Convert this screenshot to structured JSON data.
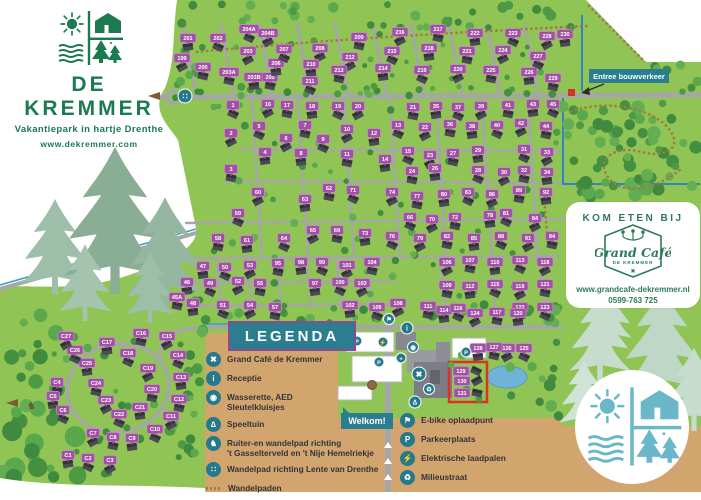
{
  "branding": {
    "name": "DE KREMMER",
    "tagline": "Vakantiepark in hartje Drenthe",
    "website": "www.dekremmer.com"
  },
  "cafe": {
    "heading": "KOM ETEN BIJ",
    "name": "Grand Café",
    "subname": "DE KREMMER",
    "website": "www.grandcafe-dekremmer.nl",
    "phone": "0599-763 725"
  },
  "signs": {
    "legend_title": "LEGENDA",
    "welcome": "Welkom!",
    "construction_entrance": "Entree bouwverkeer"
  },
  "legend": {
    "left": [
      {
        "icon": "utensils-icon",
        "glyph": "✖",
        "lines": [
          "Grand Café de Kremmer"
        ]
      },
      {
        "icon": "info-icon",
        "glyph": "i",
        "lines": [
          "Receptie"
        ]
      },
      {
        "icon": "washer-icon",
        "glyph": "◉",
        "lines": [
          "Wasserette, AED",
          "Sleutelkluisjes"
        ]
      },
      {
        "icon": "playground-icon",
        "glyph": "∆",
        "lines": [
          "Speeltuin"
        ]
      },
      {
        "icon": "horse-icon",
        "glyph": "♞",
        "lines": [
          "Ruiter-en wandelpad richting",
          "'t Gasselterveld en 't Nije Hemelriekje"
        ]
      },
      {
        "icon": "footsteps-icon",
        "glyph": "∷",
        "lines": [
          "Wandelpad richting Lente van Drenthe"
        ]
      },
      {
        "icon": "dashed-path-icon",
        "glyph": "",
        "lines": [
          "Wandelpaden"
        ]
      }
    ],
    "right": [
      {
        "icon": "ebike-icon",
        "glyph": "⚑",
        "lines": [
          "E-bike oplaadpunt"
        ]
      },
      {
        "icon": "parking-icon",
        "glyph": "P",
        "lines": [
          "Parkeerplaats"
        ]
      },
      {
        "icon": "ev-charger-icon",
        "glyph": "⚡",
        "lines": [
          "Elektrische laadpalen"
        ]
      },
      {
        "icon": "trash-icon",
        "glyph": "♻",
        "lines": [
          "Milieustraat"
        ]
      }
    ]
  },
  "colors": {
    "map_green": "#90c454",
    "sand": "#d2a56f",
    "road": "#a6a6a9",
    "teal": "#25798b",
    "banner_teal": "#2a7e90",
    "banner_border": "#8d4a8f",
    "label_purple": "#a151a3",
    "brand_green": "#1b7a4f",
    "cafe_green": "#2d7a57",
    "blue_route": "#2f86c4",
    "highlight_red": "#e03024"
  },
  "map": {
    "houses": [
      [
        "199",
        182,
        58
      ],
      [
        "200",
        203,
        67
      ],
      [
        "201",
        188,
        38
      ],
      [
        "202",
        218,
        38
      ],
      [
        "203",
        248,
        51
      ],
      [
        "203A",
        229,
        72
      ],
      [
        "203B",
        254,
        77
      ],
      [
        "204A",
        249,
        29
      ],
      [
        "204B",
        268,
        33
      ],
      [
        "205",
        270,
        77
      ],
      [
        "206",
        276,
        63
      ],
      [
        "207",
        284,
        49
      ],
      [
        "208",
        320,
        48
      ],
      [
        "209",
        359,
        37
      ],
      [
        "210",
        311,
        64
      ],
      [
        "211",
        310,
        81
      ],
      [
        "212",
        350,
        57
      ],
      [
        "213",
        339,
        70
      ],
      [
        "214",
        383,
        68
      ],
      [
        "215",
        392,
        51
      ],
      [
        "216",
        400,
        32
      ],
      [
        "217",
        438,
        29
      ],
      [
        "218",
        429,
        48
      ],
      [
        "219",
        422,
        70
      ],
      [
        "220",
        458,
        69
      ],
      [
        "221",
        467,
        51
      ],
      [
        "222",
        475,
        33
      ],
      [
        "223",
        513,
        33
      ],
      [
        "224",
        503,
        50
      ],
      [
        "225",
        491,
        70
      ],
      [
        "226",
        529,
        72
      ],
      [
        "227",
        538,
        56
      ],
      [
        "228",
        547,
        36
      ],
      [
        "229",
        553,
        78
      ],
      [
        "230",
        565,
        34
      ],
      [
        "1",
        233,
        105
      ],
      [
        "16",
        268,
        104
      ],
      [
        "17",
        287,
        105
      ],
      [
        "18",
        312,
        106
      ],
      [
        "19",
        338,
        106
      ],
      [
        "20",
        358,
        106
      ],
      [
        "21",
        413,
        107
      ],
      [
        "35",
        436,
        106
      ],
      [
        "37",
        458,
        107
      ],
      [
        "39",
        481,
        106
      ],
      [
        "41",
        508,
        105
      ],
      [
        "43",
        533,
        104
      ],
      [
        "45",
        553,
        104
      ],
      [
        "2",
        231,
        133
      ],
      [
        "3",
        231,
        169
      ],
      [
        "4",
        265,
        152
      ],
      [
        "5",
        259,
        126
      ],
      [
        "6",
        286,
        138
      ],
      [
        "7",
        305,
        125
      ],
      [
        "8",
        301,
        153
      ],
      [
        "9",
        323,
        139
      ],
      [
        "10",
        347,
        129
      ],
      [
        "11",
        347,
        154
      ],
      [
        "12",
        374,
        133
      ],
      [
        "13",
        398,
        125
      ],
      [
        "22",
        425,
        127
      ],
      [
        "36",
        450,
        124
      ],
      [
        "38",
        472,
        126
      ],
      [
        "40",
        497,
        125
      ],
      [
        "42",
        521,
        123
      ],
      [
        "44",
        546,
        126
      ],
      [
        "14",
        385,
        159
      ],
      [
        "15",
        408,
        151
      ],
      [
        "23",
        430,
        155
      ],
      [
        "27",
        453,
        153
      ],
      [
        "29",
        478,
        150
      ],
      [
        "31",
        524,
        149
      ],
      [
        "33",
        547,
        152
      ],
      [
        "24",
        412,
        171
      ],
      [
        "26",
        435,
        168
      ],
      [
        "28",
        478,
        170
      ],
      [
        "30",
        504,
        172
      ],
      [
        "32",
        524,
        170
      ],
      [
        "34",
        547,
        172
      ],
      [
        "59",
        238,
        213
      ],
      [
        "60",
        258,
        192
      ],
      [
        "62",
        329,
        188
      ],
      [
        "63",
        305,
        199
      ],
      [
        "71",
        353,
        190
      ],
      [
        "74",
        392,
        192
      ],
      [
        "77",
        417,
        196
      ],
      [
        "80",
        444,
        194
      ],
      [
        "83",
        468,
        192
      ],
      [
        "86",
        492,
        194
      ],
      [
        "89",
        519,
        190
      ],
      [
        "92",
        546,
        192
      ],
      [
        "66",
        410,
        217
      ],
      [
        "70",
        432,
        219
      ],
      [
        "72",
        455,
        217
      ],
      [
        "78",
        490,
        215
      ],
      [
        "81",
        506,
        213
      ],
      [
        "84",
        535,
        218
      ],
      [
        "58",
        218,
        238
      ],
      [
        "61",
        247,
        240
      ],
      [
        "64",
        284,
        238
      ],
      [
        "65",
        313,
        230
      ],
      [
        "69",
        337,
        230
      ],
      [
        "73",
        365,
        233
      ],
      [
        "76",
        392,
        236
      ],
      [
        "79",
        420,
        238
      ],
      [
        "82",
        447,
        236
      ],
      [
        "85",
        474,
        238
      ],
      [
        "88",
        501,
        236
      ],
      [
        "91",
        528,
        238
      ],
      [
        "94",
        552,
        236
      ],
      [
        "47",
        203,
        266
      ],
      [
        "50",
        225,
        267
      ],
      [
        "53",
        250,
        265
      ],
      [
        "95",
        278,
        263
      ],
      [
        "98",
        301,
        262
      ],
      [
        "99",
        322,
        262
      ],
      [
        "101",
        347,
        265
      ],
      [
        "104",
        372,
        262
      ],
      [
        "46",
        187,
        282
      ],
      [
        "49",
        210,
        283
      ],
      [
        "52",
        238,
        281
      ],
      [
        "55",
        260,
        283
      ],
      [
        "97",
        315,
        283
      ],
      [
        "100",
        340,
        282
      ],
      [
        "103",
        362,
        283
      ],
      [
        "45A",
        177,
        297
      ],
      [
        "48",
        193,
        303
      ],
      [
        "51",
        223,
        305
      ],
      [
        "54",
        250,
        305
      ],
      [
        "57",
        275,
        307
      ],
      [
        "102",
        350,
        305
      ],
      [
        "105",
        377,
        307
      ],
      [
        "106",
        447,
        262
      ],
      [
        "107",
        470,
        260
      ],
      [
        "110",
        495,
        262
      ],
      [
        "113",
        520,
        260
      ],
      [
        "118",
        545,
        262
      ],
      [
        "109",
        447,
        285
      ],
      [
        "112",
        470,
        286
      ],
      [
        "115",
        495,
        284
      ],
      [
        "119",
        520,
        286
      ],
      [
        "121",
        545,
        284
      ],
      [
        "122",
        520,
        307
      ],
      [
        "123",
        545,
        307
      ],
      [
        "108",
        398,
        303
      ],
      [
        "111",
        428,
        306
      ],
      [
        "114",
        444,
        310
      ],
      [
        "116",
        458,
        308
      ],
      [
        "124",
        475,
        313
      ],
      [
        "117",
        497,
        312
      ],
      [
        "120",
        518,
        313
      ],
      [
        "125",
        524,
        348
      ],
      [
        "126",
        507,
        348
      ],
      [
        "127",
        494,
        347
      ],
      [
        "128",
        478,
        348
      ],
      [
        "129",
        461,
        371
      ],
      [
        "130",
        462,
        381
      ],
      [
        "131",
        462,
        393
      ],
      [
        "C1",
        68,
        455
      ],
      [
        "C2",
        88,
        458
      ],
      [
        "C3",
        110,
        460
      ],
      [
        "C4",
        57,
        382
      ],
      [
        "C5",
        53,
        396
      ],
      [
        "C6",
        63,
        410
      ],
      [
        "C7",
        93,
        433
      ],
      [
        "C8",
        113,
        437
      ],
      [
        "C9",
        132,
        438
      ],
      [
        "C10",
        155,
        429
      ],
      [
        "C11",
        171,
        416
      ],
      [
        "C12",
        179,
        399
      ],
      [
        "C13",
        181,
        377
      ],
      [
        "C14",
        178,
        355
      ],
      [
        "C15",
        167,
        336
      ],
      [
        "C16",
        141,
        333
      ],
      [
        "C17",
        107,
        342
      ],
      [
        "C18",
        128,
        353
      ],
      [
        "C19",
        148,
        368
      ],
      [
        "C20",
        152,
        389
      ],
      [
        "C21",
        140,
        407
      ],
      [
        "C22",
        119,
        414
      ],
      [
        "C23",
        106,
        400
      ],
      [
        "C24",
        96,
        383
      ],
      [
        "C25",
        87,
        363
      ],
      [
        "C26",
        75,
        350
      ],
      [
        "C27",
        66,
        336
      ]
    ],
    "highlighted_houses": [
      "129",
      "130",
      "131"
    ],
    "pois": [
      {
        "name": "footpath-exit-marker",
        "glyph": "∷",
        "x": 185,
        "y": 96,
        "r": 7
      },
      {
        "name": "reception-marker",
        "glyph": "i",
        "x": 407,
        "y": 328,
        "r": 6
      },
      {
        "name": "ebike-marker",
        "glyph": "⚑",
        "x": 389,
        "y": 319,
        "r": 5.5
      },
      {
        "name": "ev-charger-marker",
        "glyph": "⚡",
        "x": 383,
        "y": 342,
        "r": 5
      },
      {
        "name": "wasserette-marker",
        "glyph": "◉",
        "x": 413,
        "y": 347,
        "r": 5.5
      },
      {
        "name": "aed-marker",
        "glyph": "+",
        "x": 401,
        "y": 358,
        "r": 5
      },
      {
        "name": "grand-cafe-marker",
        "glyph": "✖",
        "x": 419,
        "y": 374,
        "r": 7
      },
      {
        "name": "milieustraat-marker",
        "glyph": "♻",
        "x": 429,
        "y": 389,
        "r": 5.5
      },
      {
        "name": "playground-marker",
        "glyph": "∆",
        "x": 415,
        "y": 402,
        "r": 6
      },
      {
        "name": "parking-marker",
        "glyph": "P",
        "x": 357,
        "y": 341,
        "r": 5
      },
      {
        "name": "parking-marker",
        "glyph": "P",
        "x": 379,
        "y": 362,
        "r": 5
      },
      {
        "name": "parking-marker",
        "glyph": "P",
        "x": 466,
        "y": 352,
        "r": 5
      }
    ]
  }
}
